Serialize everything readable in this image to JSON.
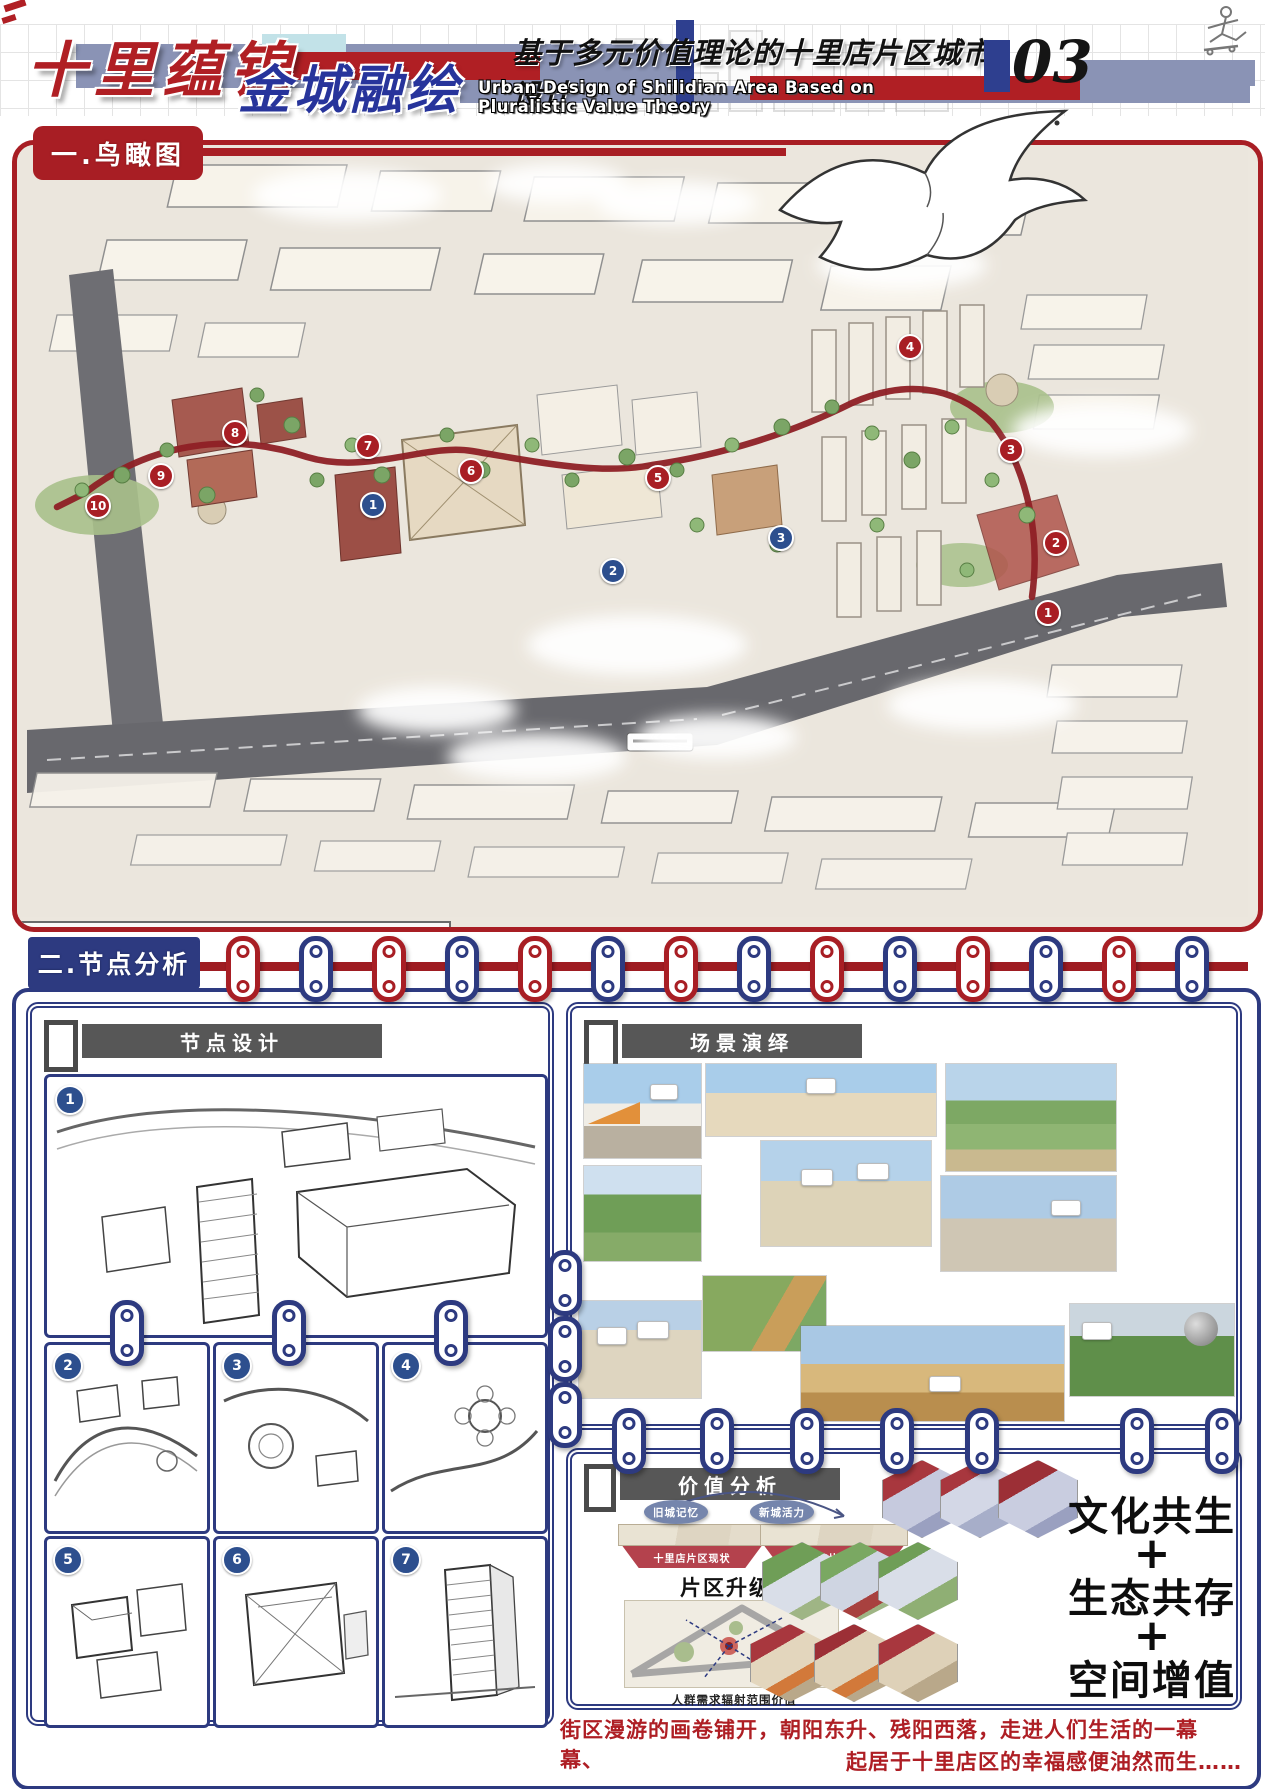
{
  "header": {
    "title1": "十里蕴锦",
    "title2": "金城融绘",
    "subtitle_cn": "基于多元价值理论的十里店片区城市设计",
    "subtitle_en": "Urban Design of Shilidian Area Based on Pluralistic Value Theory",
    "page": "03"
  },
  "colors": {
    "accent_red": "#a81e24",
    "accent_navy": "#2d3a80",
    "bar_grayblue": "#8a93b5",
    "bar_cyan": "#c2e2e8"
  },
  "s1": {
    "title": "一.鸟瞰图",
    "legend": {
      "blue": [
        {
          "num": "1",
          "label": "院聚服园"
        },
        {
          "num": "2",
          "label": "市集新园"
        },
        {
          "num": "3",
          "label": "文延展园"
        }
      ],
      "red1": [
        {
          "num": "1",
          "label": "津渡广场（渡口文化）"
        },
        {
          "num": "2",
          "label": "陶艺广场（彩陶文化）"
        },
        {
          "num": "3",
          "label": "陇耕绿圃（农耕文化）"
        },
        {
          "num": "4",
          "label": "陇上墨香（黄河文化）"
        },
        {
          "num": "5",
          "label": "雄军广场（军戍文化）"
        }
      ],
      "red2": [
        {
          "num": "6",
          "label": "民俗文馆（民族文化）"
        },
        {
          "num": "7",
          "label": "锻铸塑园（工业文化）"
        },
        {
          "num": "8",
          "label": "研耕文院（书院文化）"
        },
        {
          "num": "9",
          "label": "丝路连廊（丝路文化）"
        },
        {
          "num": "10",
          "label": "绿境栖园（生态文化）"
        }
      ]
    },
    "red_nums": [
      "1",
      "2",
      "3",
      "4",
      "5",
      "6",
      "7",
      "8",
      "9",
      "10"
    ],
    "blue_nums": [
      "1",
      "2",
      "3"
    ]
  },
  "s2": {
    "title": "二.节点分析",
    "node": {
      "title": "节点设计",
      "markers": [
        "1",
        "2",
        "3",
        "4",
        "5",
        "6",
        "7"
      ]
    },
    "scene": {
      "title": "场景演绎"
    },
    "value": {
      "title": "价值分析",
      "bubble_left": "旧城记忆",
      "bubble_right": "新城活力",
      "base_left": "十里店片区现状",
      "base_right": "十里店片区改造",
      "caption1": "片区升级改造价值",
      "caption2": "人群需求辐射范围价值",
      "slogan": [
        "文化共生",
        "+",
        "生态共存",
        "+",
        "空间增值"
      ]
    },
    "closing1": "街区漫游的画卷铺开，朝阳东升、残阳西落，走进人们生活的一幕幕、",
    "closing2": "起居于十里店区的幸福感便油然而生……"
  }
}
